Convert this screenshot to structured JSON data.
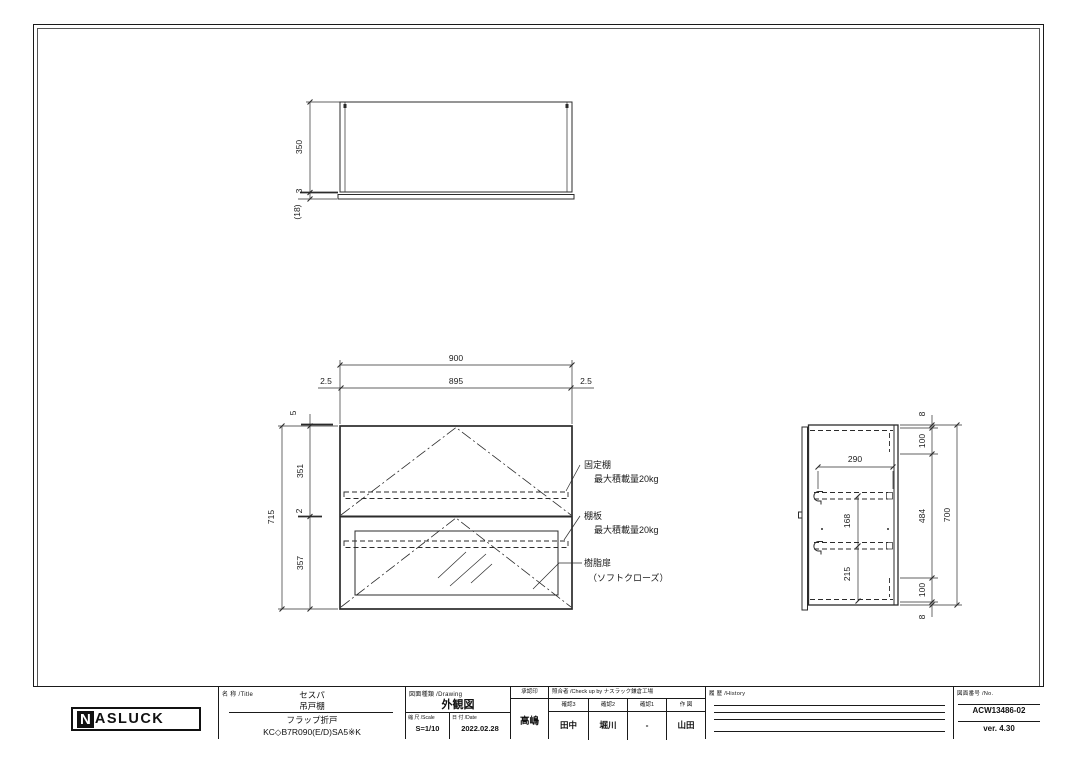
{
  "drawing": {
    "dims": {
      "top_depth": "350",
      "top_gap": "3",
      "top_door": "(18)",
      "f_w": "900",
      "f_iw": "895",
      "f_g1": "2.5",
      "f_g2": "2.5",
      "f_top": "5",
      "f_up": "351",
      "f_mid": "2",
      "f_low": "357",
      "f_h": "715",
      "s_d": "290",
      "s_a": "168",
      "s_b": "215",
      "s_t8": "8",
      "s_100a": "100",
      "s_484": "484",
      "s_100b": "100",
      "s_b8": "8",
      "s_h": "700"
    },
    "callouts": {
      "fixed_shelf": "固定棚",
      "fixed_shelf_load": "最大積載量20kg",
      "shelf": "棚板",
      "shelf_load": "最大積載量20kg",
      "door": "樹脂扉",
      "door_note": "（ソフトクローズ）"
    }
  },
  "title_block": {
    "logo_n": "N",
    "logo_rest": "ASLUCK",
    "title_label": "名 称 /Title",
    "title_line1": "セスパ",
    "title_line2": "吊戸棚",
    "title_line3": "フラップ折戸",
    "title_line4": "KC◇B7R090(E/D)SA5※K",
    "drawing_label": "図面種類 /Drawing",
    "drawing_type": "外観図",
    "scale_label": "縮 尺 /Scale",
    "scale": "S=1/10",
    "date_label": "日 付 /Date",
    "date": "2022.02.28",
    "approval_label": "承認印",
    "approval": "高嶋",
    "check_label": "照合者 /Check up by ナスラック鎌倉工場",
    "check_cols": [
      "確認3",
      "確認2",
      "確認1",
      "作 図"
    ],
    "check_values": [
      "田中",
      "堀川",
      "-",
      "山田"
    ],
    "history_label": "履 歴 /History",
    "no_label": "図面番号 /No.",
    "drawing_no": "ACW13486-02",
    "version": "ver. 4.30"
  }
}
